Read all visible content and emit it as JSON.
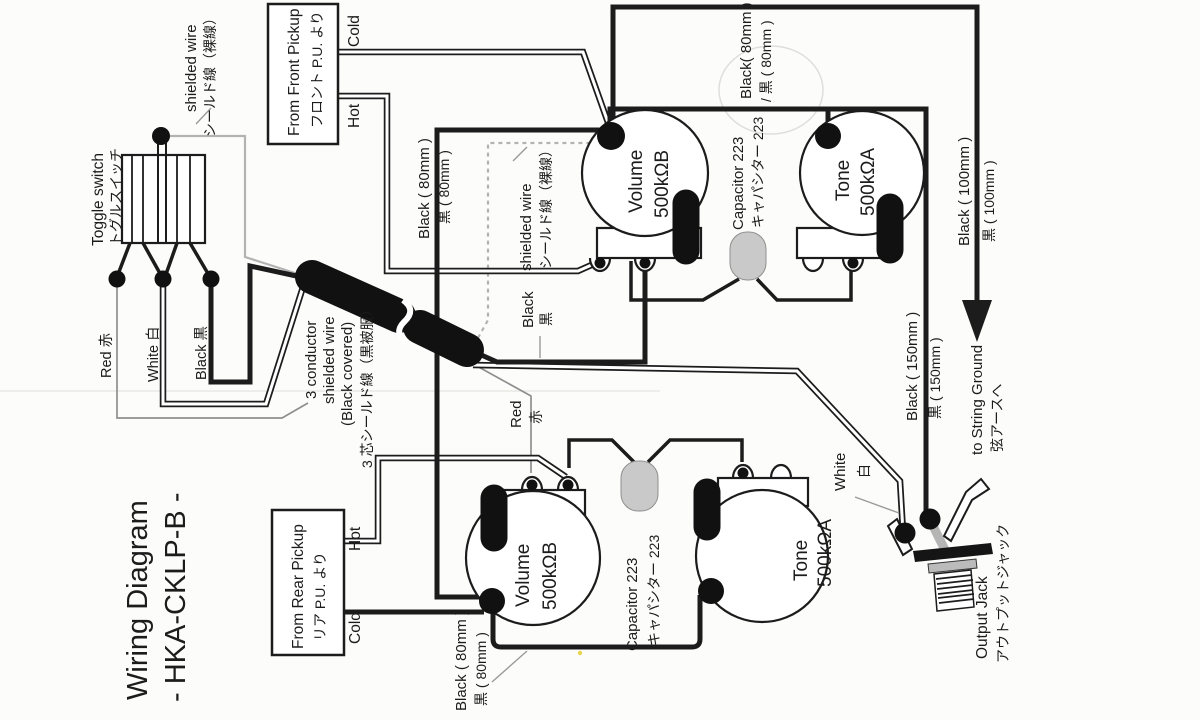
{
  "title": {
    "line1": "Wiring Diagram",
    "line2": "- HKA-CKLP-B -"
  },
  "toggle_switch": {
    "en": "Toggle switch",
    "jp": "トグルスイッチ",
    "wire_red": "Red  赤",
    "wire_white": "White  白",
    "wire_black": "Black  黒"
  },
  "front_pickup": {
    "en": "From Front Pickup",
    "jp": "フロント P.U. より",
    "cold": "Cold",
    "hot": "Hot"
  },
  "rear_pickup": {
    "en": "From Rear Pickup",
    "jp": "リア P.U. より",
    "cold": "Cold",
    "hot": "Hot"
  },
  "front_controls": {
    "volume": "Volume",
    "volume_value": "500kΩB",
    "capacitor": "Capacitor 223",
    "capacitor_jp": "キャパシター 223",
    "tone": "Tone",
    "tone_value": "500kΩA"
  },
  "rear_controls": {
    "volume": "Volume",
    "volume_value": "500kΩB",
    "capacitor": "Capacitor 223",
    "capacitor_jp": "キャパシター 223",
    "tone": "Tone",
    "tone_value": "500kΩA"
  },
  "wires": {
    "shielded_bare_switch": {
      "en": "shielded wire",
      "jp": "シールド線（裸線）"
    },
    "shielded_bare_volume": {
      "en": "shielded wire",
      "jp": "シールド線（裸線）"
    },
    "three_conductor": {
      "en_1": "3 conductor",
      "en_2": "shielded wire",
      "en_3": "(Black covered)",
      "jp": "3 芯シールド線（黒被服）"
    },
    "black_80_switch": {
      "en": "Black ( 80mm )",
      "jp": "黒 ( 80mm )"
    },
    "black_80_front": {
      "en": "Black( 80mm )",
      "jp": "/ 黒 ( 80mm )"
    },
    "black_80_rear": {
      "en": "Black ( 80mm )",
      "jp": "黒 ( 80mm )"
    },
    "black_100": {
      "en": "Black ( 100mm )",
      "jp": "黒 ( 100mm )"
    },
    "black_150": {
      "en": "Black ( 150mm )",
      "jp": "黒 ( 150mm )"
    },
    "black_conductor": {
      "en": "Black",
      "jp": "黒"
    },
    "red_conductor": {
      "en": "Red",
      "jp": "赤"
    },
    "white_to_jack": {
      "en": "White",
      "jp": "白"
    }
  },
  "output_jack": {
    "en": "Output Jack",
    "jp": "アウトプットジャック"
  },
  "string_ground": {
    "en": "to String Ground",
    "jp": "弦アースへ"
  },
  "colors": {
    "ink": "#1c1c1c",
    "paper": "#fcfcfa",
    "bare_shield": "#b3b3b3",
    "capacitor_fill": "#c9c9c9",
    "jack_metal": "#b5b5b5"
  }
}
